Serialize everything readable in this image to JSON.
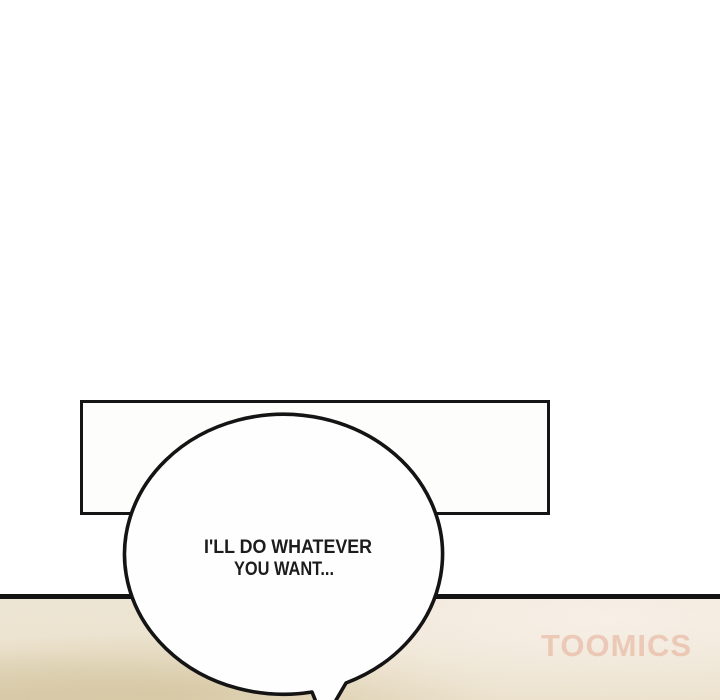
{
  "speech_bubble": {
    "lines": [
      "I'LL DO WHATEVER",
      "YOU WANT..."
    ]
  },
  "watermark": {
    "text": "TOOMICS"
  },
  "colors": {
    "ink": "#141414",
    "paper": "#ffffff",
    "bubble_fill": "#fefefe",
    "ground_tan": "#d9cdae",
    "ground_cream": "#f2ebdf",
    "watermark_pink": "#e8977c"
  }
}
